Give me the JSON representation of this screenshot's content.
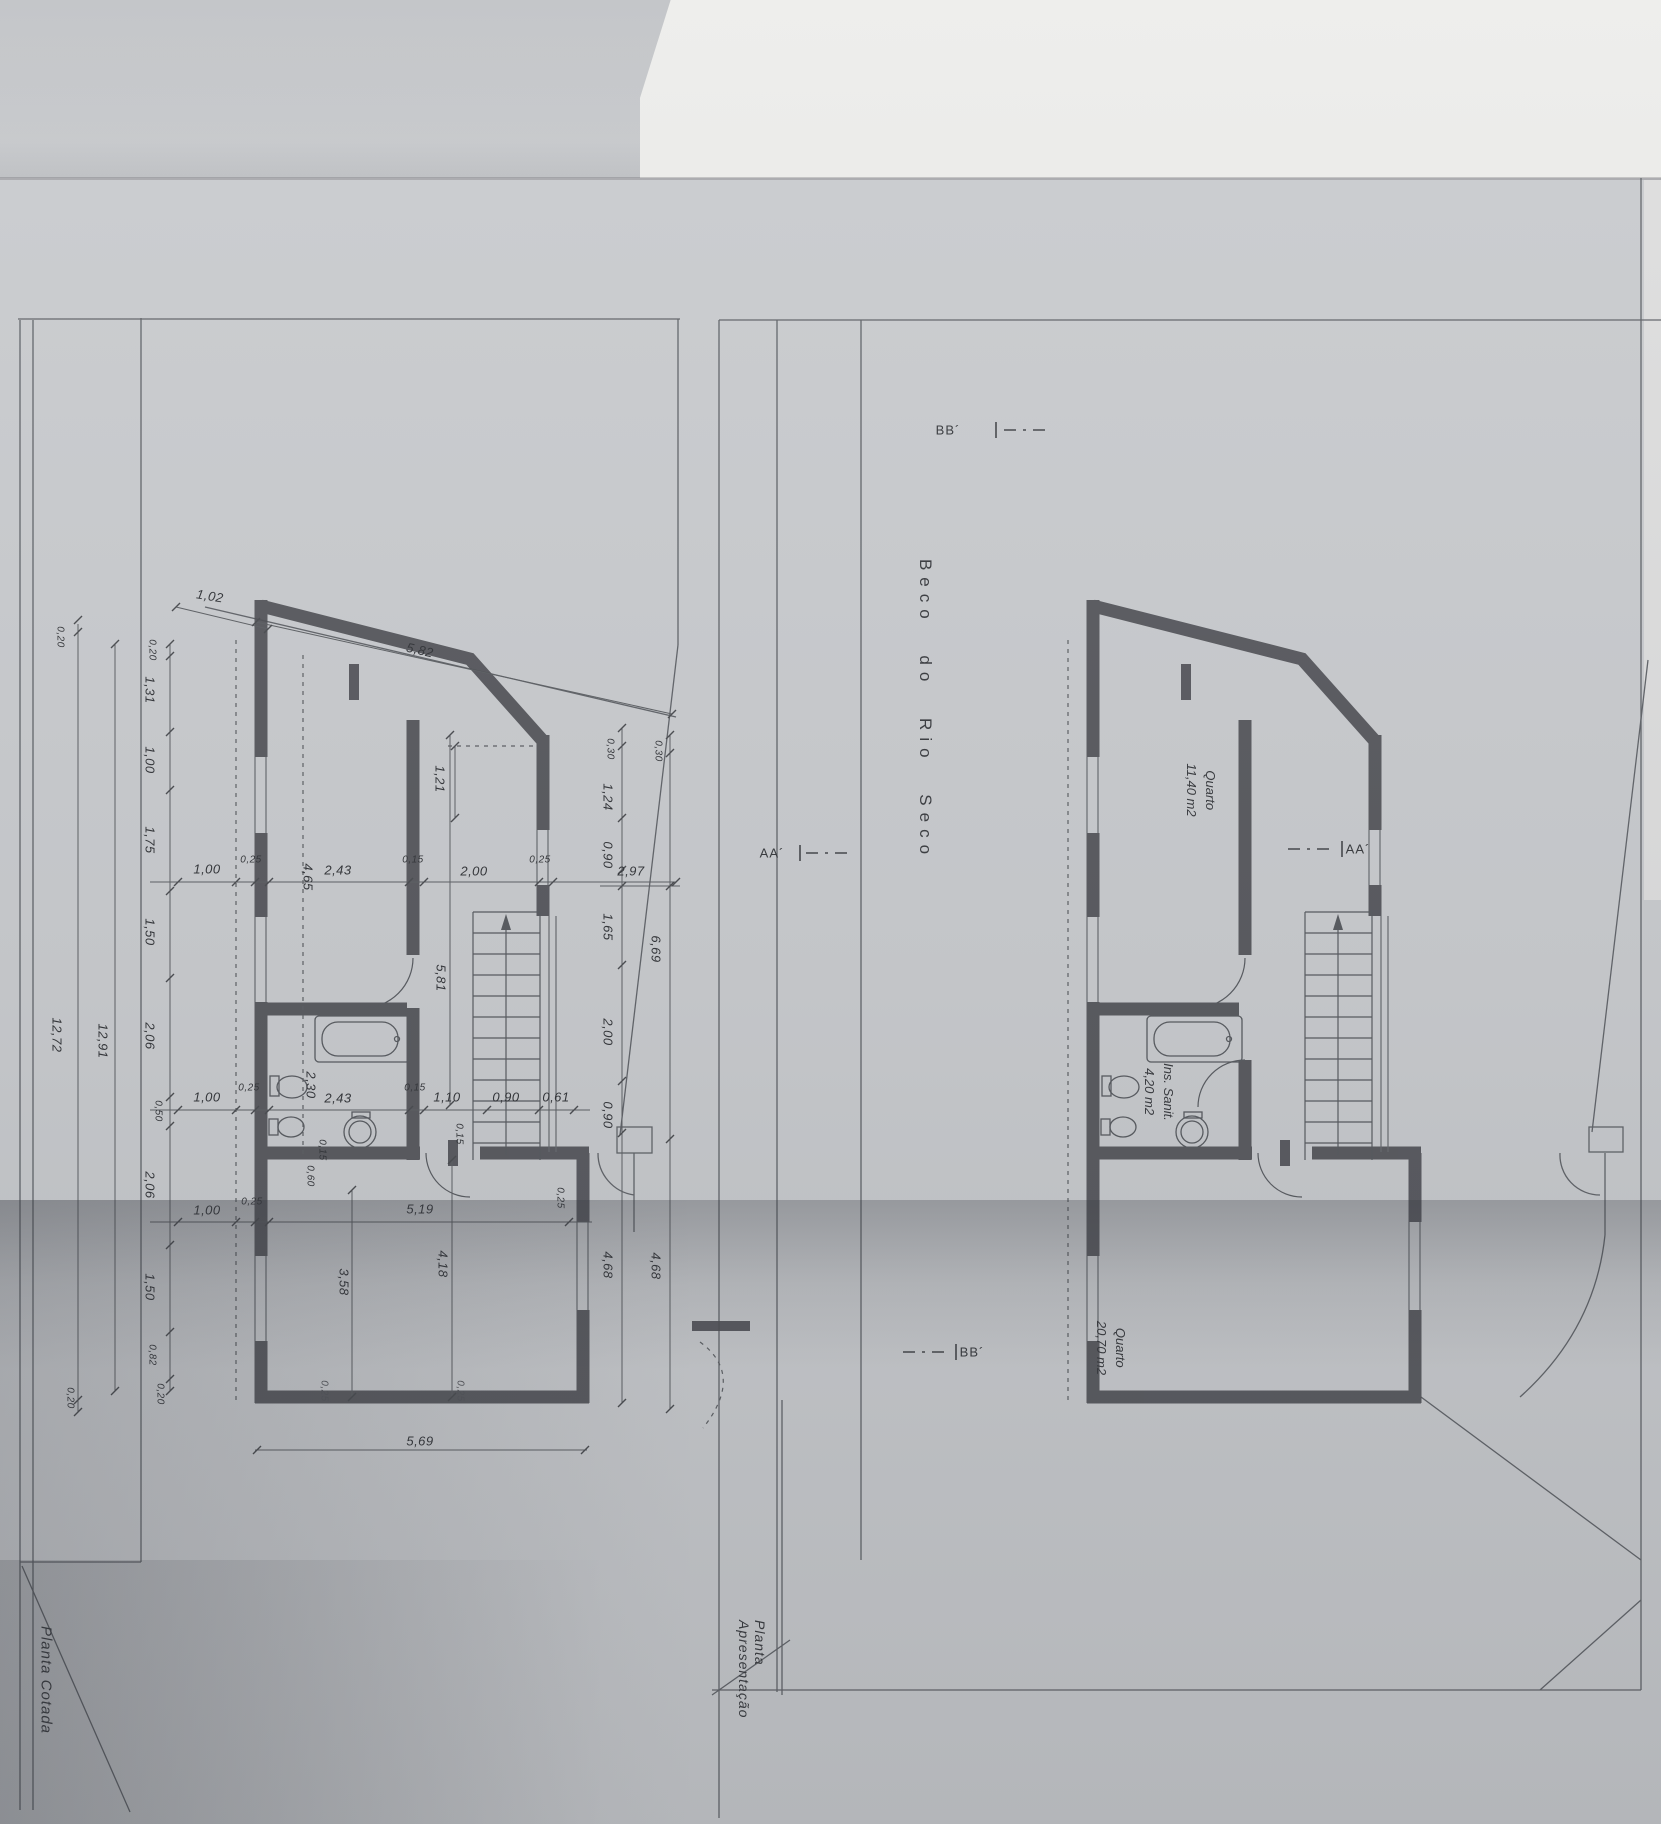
{
  "sheet": {
    "left_title": "Planta Cotada",
    "right_title": "Planta Apresentação",
    "street": "Beco do Rio Seco",
    "section_aa": "AA´",
    "section_bb": "BB´"
  },
  "rooms": {
    "bedroom1": {
      "name": "Quarto",
      "area": "11,40 m2"
    },
    "bath": {
      "name": "Ins. Sanit.",
      "area": "4,20 m2"
    },
    "bedroom2": {
      "name": "Quarto",
      "area": "20,70 m2"
    }
  },
  "dims": {
    "top": [
      "1,02",
      "5,82"
    ],
    "left_inner": [
      "0,20",
      "1,31",
      "1,00",
      "1,75",
      "1,50",
      "2,06",
      "0,50",
      "2,06",
      "1,50",
      "0,82",
      "0,20"
    ],
    "left_total_inner": "12,91",
    "left_outer_top": "0,20",
    "left_total_outer": "12,72",
    "left_outer_bottom": "0,20",
    "chain_a": [
      "1,00",
      "0,25",
      "4,65",
      "2,43",
      "0,15",
      "2,00",
      "0,25"
    ],
    "chain_b": [
      "1,00",
      "0,25",
      "2,30",
      "2,43",
      "0,15",
      "1,10",
      "0,90",
      "0,61"
    ],
    "chain_c": [
      "1,00",
      "0,25",
      "5,19"
    ],
    "bottom": "5,69",
    "right_inner": [
      "0,30",
      "1,24",
      "0,90",
      "1,65",
      "2,00",
      "0,90",
      "4,68"
    ],
    "right_outer": [
      "0,30",
      "6,69",
      "4,68"
    ],
    "right_horiz": "2,97",
    "interior": [
      "1,21",
      "5,81",
      "0,15",
      "0,60",
      "3,58",
      "4,18",
      "0,15",
      "0,25",
      "0,25",
      "0,25"
    ]
  }
}
